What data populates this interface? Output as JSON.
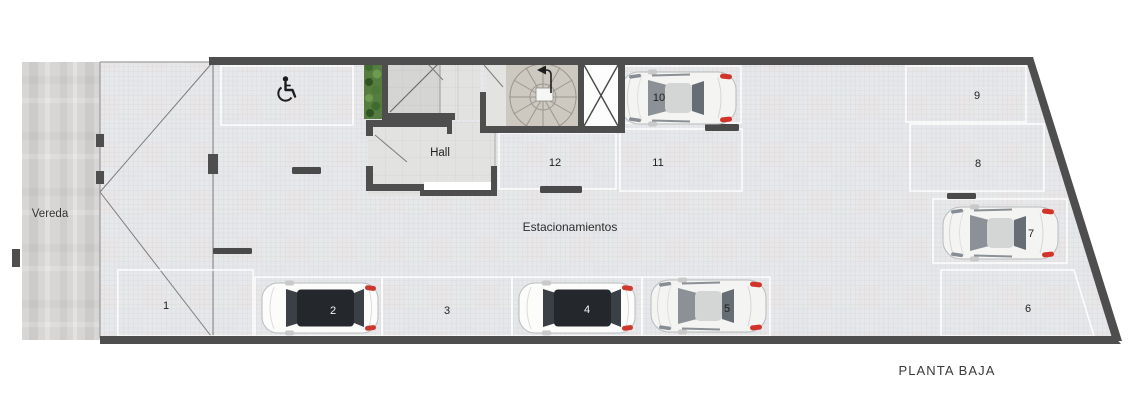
{
  "title": {
    "text": "PLANTA BAJA"
  },
  "labels": {
    "sidewalk": "Vereda",
    "hall": "Hall",
    "parking_area": "Estacionamientos"
  },
  "parking_spots": [
    {
      "number": "1",
      "occupied": false
    },
    {
      "number": "2",
      "occupied": true,
      "vehicle": "white-suv-dark-roof"
    },
    {
      "number": "3",
      "occupied": false
    },
    {
      "number": "4",
      "occupied": true,
      "vehicle": "white-suv-dark-roof"
    },
    {
      "number": "5",
      "occupied": true,
      "vehicle": "white-coupe"
    },
    {
      "number": "6",
      "occupied": false
    },
    {
      "number": "7",
      "occupied": true,
      "vehicle": "white-coupe"
    },
    {
      "number": "8",
      "occupied": false
    },
    {
      "number": "9",
      "occupied": false
    },
    {
      "number": "10",
      "occupied": true,
      "vehicle": "white-coupe"
    },
    {
      "number": "11",
      "occupied": false
    },
    {
      "number": "12",
      "occupied": false
    }
  ],
  "accessible_spot": {
    "icon": "wheelchair-symbol"
  },
  "features": {
    "staircase": "spiral-staircase",
    "elevator": "elevator-shaft-x",
    "hedge": "green-hedge",
    "entrance": "vehicle-ramp-entrance"
  },
  "colors": {
    "wall": "#4e4e4e",
    "floor": "#eaebed",
    "spot_outline": "#ffffff",
    "taillight_red": "#d3342a",
    "hedge_green": "#4c7a38",
    "stair_floor": "#cdc9c0",
    "hall_floor": "#e2e2e0",
    "sidewalk_concrete": "#d7d6d4",
    "suv_roof": "#24272b"
  }
}
